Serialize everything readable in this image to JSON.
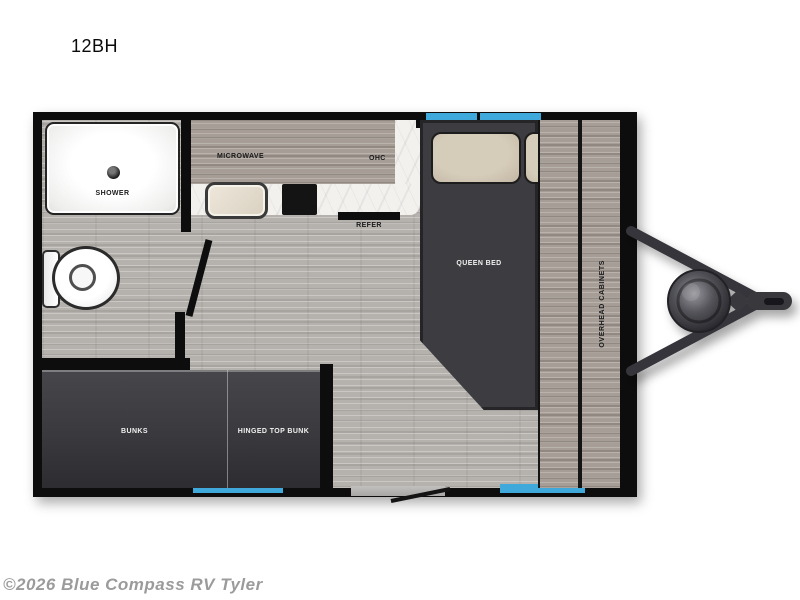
{
  "page": {
    "title": "12BH",
    "watermark": "©2026 Blue Compass RV Tyler"
  },
  "floorplan": {
    "rooms": {
      "shower": "SHOWER",
      "microwave": "MICROWAVE",
      "ohc": "OHC",
      "refer": "REFER",
      "queen_bed": "QUEEN BED",
      "overhead_cabinets": "OVERHEAD CABINETS",
      "bunks": "BUNKS",
      "hinged_top_bunk": "HINGED TOP BUNK"
    },
    "features": [
      "shower-drain",
      "toilet",
      "sink",
      "cooktop",
      "entry-door",
      "windows",
      "a-frame-tongue",
      "propane-tank",
      "hitch-coupler"
    ],
    "colors": {
      "wall_black": "#0d0d0d",
      "floor_wood": "#b5b2ae",
      "cabinet_wood": "#a69d96",
      "dark_furniture": "#3d3d41",
      "counter_marble": "#f3f1ee",
      "window_blue": "#3fa9dc",
      "pillow_beige": "#cdc2b0",
      "watermark_gray": "#9b9b9b"
    }
  }
}
